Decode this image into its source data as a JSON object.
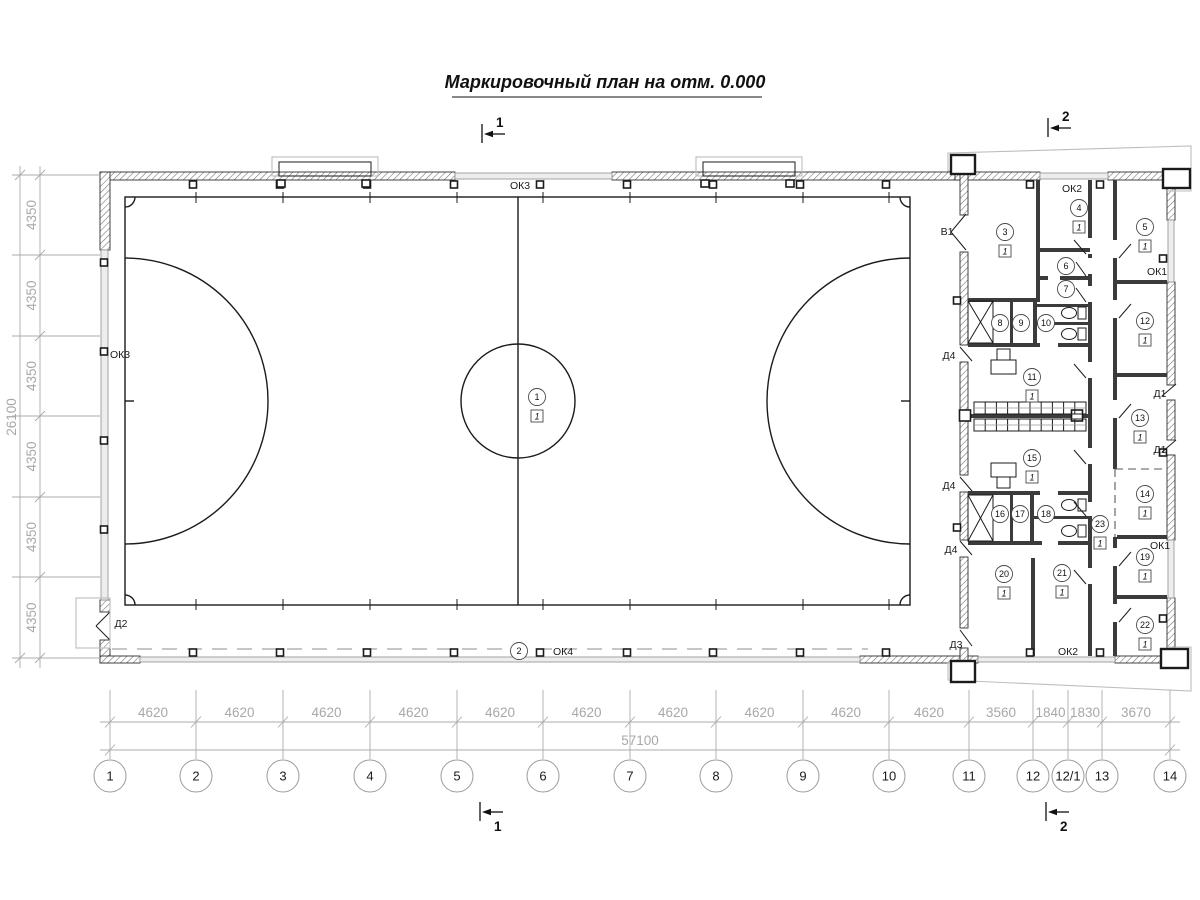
{
  "title": "Маркировочный план на отм. 0.000",
  "sections": [
    {
      "label": "1",
      "x": 482,
      "y": 134,
      "tx": 496,
      "ty": 127
    },
    {
      "label": "1",
      "x": 480,
      "y": 812,
      "tx": 494,
      "ty": 831
    },
    {
      "label": "2",
      "x": 1048,
      "y": 128,
      "tx": 1062,
      "ty": 121
    },
    {
      "label": "2",
      "x": 1046,
      "y": 812,
      "tx": 1060,
      "ty": 831
    }
  ],
  "grid": {
    "columns": [
      {
        "label": "1",
        "x": 110
      },
      {
        "label": "2",
        "x": 196
      },
      {
        "label": "3",
        "x": 283
      },
      {
        "label": "4",
        "x": 370
      },
      {
        "label": "5",
        "x": 457
      },
      {
        "label": "6",
        "x": 543
      },
      {
        "label": "7",
        "x": 630
      },
      {
        "label": "8",
        "x": 716
      },
      {
        "label": "9",
        "x": 803
      },
      {
        "label": "10",
        "x": 889
      },
      {
        "label": "11",
        "x": 969
      },
      {
        "label": "12",
        "x": 1033
      },
      {
        "label": "12/1",
        "x": 1068
      },
      {
        "label": "13",
        "x": 1102
      },
      {
        "label": "14",
        "x": 1170
      }
    ],
    "span_labels": [
      "4620",
      "4620",
      "4620",
      "4620",
      "4620",
      "4620",
      "4620",
      "4620",
      "4620",
      "4620",
      "3560",
      "1840",
      "1830",
      "3670"
    ],
    "total_label": "57100"
  },
  "grid_left": {
    "ys": [
      175,
      255,
      336,
      416,
      497,
      577,
      658
    ],
    "labels": [
      "4350",
      "4350",
      "4350",
      "4350",
      "4350",
      "4350"
    ],
    "total_label": "26100"
  },
  "rooms": [
    {
      "num": "1",
      "x": 537,
      "y": 397,
      "floor": "1"
    },
    {
      "num": "2",
      "x": 519,
      "y": 651
    },
    {
      "num": "3",
      "x": 1005,
      "y": 232,
      "floor": "1"
    },
    {
      "num": "4",
      "x": 1079,
      "y": 208,
      "floor": "1"
    },
    {
      "num": "5",
      "x": 1145,
      "y": 227,
      "floor": "1"
    },
    {
      "num": "6",
      "x": 1066,
      "y": 266
    },
    {
      "num": "7",
      "x": 1066,
      "y": 289
    },
    {
      "num": "8",
      "x": 1000,
      "y": 323
    },
    {
      "num": "9",
      "x": 1021,
      "y": 323
    },
    {
      "num": "10",
      "x": 1046,
      "y": 323
    },
    {
      "num": "11",
      "x": 1032,
      "y": 377,
      "floor": "1"
    },
    {
      "num": "12",
      "x": 1145,
      "y": 321,
      "floor": "1"
    },
    {
      "num": "13",
      "x": 1140,
      "y": 418,
      "floor": "1"
    },
    {
      "num": "14",
      "x": 1145,
      "y": 494,
      "floor": "1"
    },
    {
      "num": "15",
      "x": 1032,
      "y": 458,
      "floor": "1"
    },
    {
      "num": "16",
      "x": 1000,
      "y": 514
    },
    {
      "num": "17",
      "x": 1020,
      "y": 514
    },
    {
      "num": "18",
      "x": 1046,
      "y": 514
    },
    {
      "num": "19",
      "x": 1145,
      "y": 557,
      "floor": "1"
    },
    {
      "num": "20",
      "x": 1004,
      "y": 574,
      "floor": "1"
    },
    {
      "num": "21",
      "x": 1062,
      "y": 573,
      "floor": "1"
    },
    {
      "num": "22",
      "x": 1145,
      "y": 625,
      "floor": "1"
    },
    {
      "num": "23",
      "x": 1100,
      "y": 524,
      "floor": "1"
    }
  ],
  "openings": [
    {
      "t": "ОК3",
      "x": 520,
      "y": 189
    },
    {
      "t": "ОК3",
      "x": 120,
      "y": 358
    },
    {
      "t": "ОК4",
      "x": 563,
      "y": 655
    },
    {
      "t": "ОК2",
      "x": 1072,
      "y": 192
    },
    {
      "t": "ОК2",
      "x": 1068,
      "y": 655
    },
    {
      "t": "ОК1",
      "x": 1157,
      "y": 275
    },
    {
      "t": "ОК1",
      "x": 1160,
      "y": 549
    },
    {
      "t": "В1",
      "x": 947,
      "y": 235
    },
    {
      "t": "Д2",
      "x": 121,
      "y": 627
    },
    {
      "t": "Д3",
      "x": 956,
      "y": 648
    },
    {
      "t": "Д4",
      "x": 949,
      "y": 359
    },
    {
      "t": "Д4",
      "x": 949,
      "y": 489
    },
    {
      "t": "Д4",
      "x": 951,
      "y": 553
    },
    {
      "t": "Д1",
      "x": 1160,
      "y": 397
    },
    {
      "t": "Д1",
      "x": 1160,
      "y": 453
    }
  ],
  "colors": {
    "line": "#1b1b1b",
    "dim": "#a8a8a8",
    "wall": "#3b3b3b",
    "window": "#ededed"
  }
}
